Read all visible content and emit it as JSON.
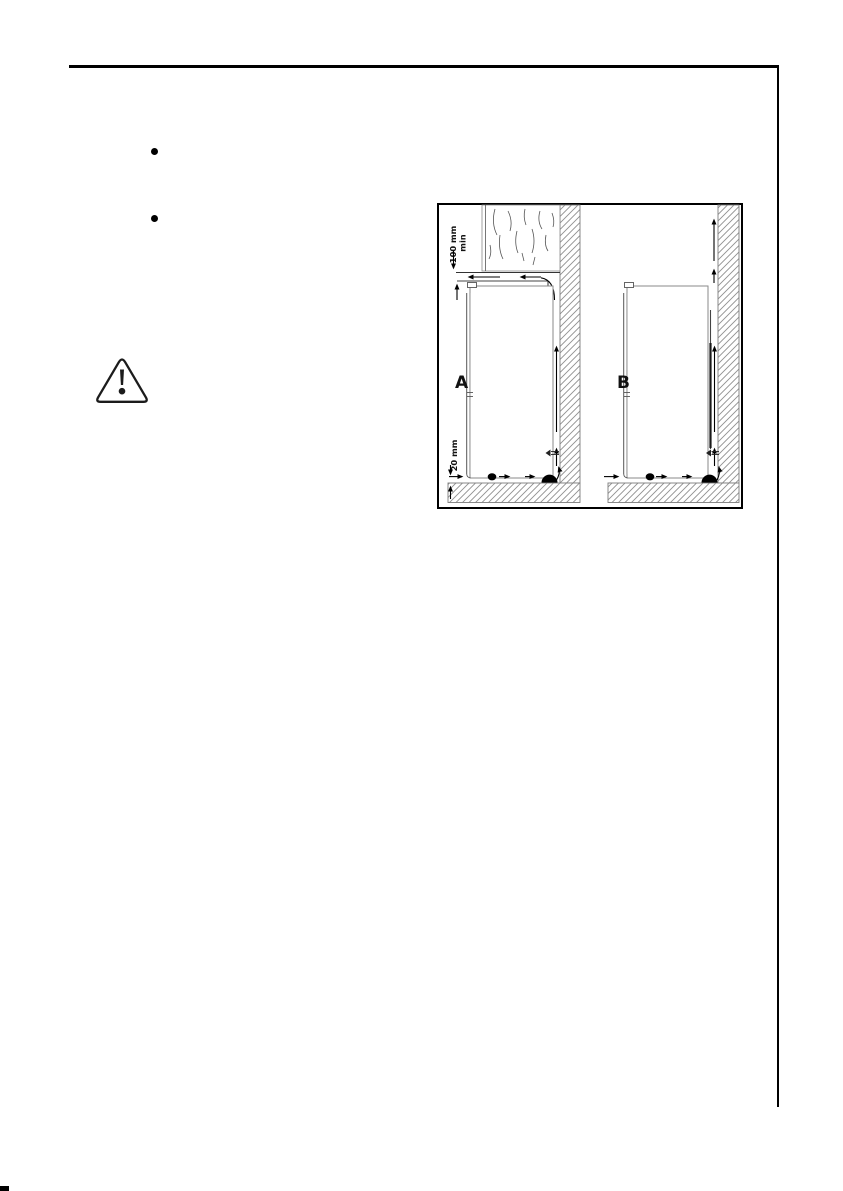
{
  "figure": {
    "dim_top_1": "100 mm",
    "dim_top_2": "min",
    "dim_bottom": "20 mm",
    "panel_a": "A",
    "panel_b": "B"
  },
  "icons": {
    "bullet_1": "list-bullet",
    "bullet_2": "list-bullet",
    "warning": "warning-triangle"
  },
  "colors": {
    "ink": "#000000",
    "diagram_line": "#555555",
    "fridge_outline": "#8a8a8a",
    "hatch_line": "#909090"
  }
}
